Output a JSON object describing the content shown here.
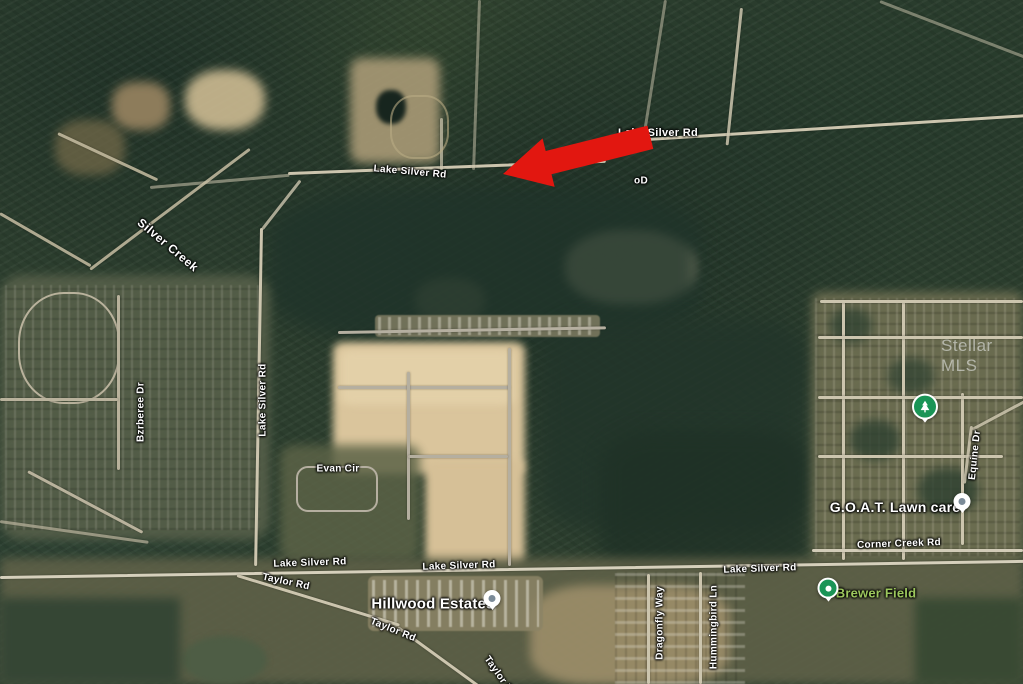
{
  "map": {
    "imagery": "satellite",
    "watermark": "Stellar MLS",
    "colors": {
      "forest_dark": "#1f3126",
      "forest": "#2c3e2e",
      "clearing_sand": "#dac59c",
      "clearing_brown": "#9b8a66",
      "road": "#ccc5ae",
      "road_gray": "#b5afa0",
      "water": "#4e5d45",
      "arrow_red": "#e21710",
      "poi_pin_green": "#1a9456",
      "park_label_green": "#9cc75d",
      "label_white": "#ffffff"
    },
    "road_labels": [
      {
        "text": "Lake Silver Rd",
        "x": 658,
        "y": 133,
        "rot": 0,
        "fs": 11
      },
      {
        "text": "Lake Silver Rd",
        "x": 410,
        "y": 172,
        "rot": 5,
        "fs": 10
      },
      {
        "text": "Silver Creek",
        "x": 168,
        "y": 245,
        "rot": 40,
        "fs": 12,
        "cls": "creek"
      },
      {
        "text": "Bzrberee Dr",
        "x": 141,
        "y": 412,
        "rot": -90,
        "fs": 10
      },
      {
        "text": "Lake Silver Rd",
        "x": 263,
        "y": 400,
        "rot": -90,
        "fs": 10
      },
      {
        "text": "Evan Cir",
        "x": 338,
        "y": 469,
        "rot": 0,
        "fs": 10
      },
      {
        "text": "Lake Silver Rd",
        "x": 310,
        "y": 563,
        "rot": -2,
        "fs": 10
      },
      {
        "text": "Lake Silver Rd",
        "x": 459,
        "y": 566,
        "rot": -2,
        "fs": 10
      },
      {
        "text": "Lake Silver Rd",
        "x": 760,
        "y": 569,
        "rot": -2,
        "fs": 10
      },
      {
        "text": "Taylor Rd",
        "x": 286,
        "y": 582,
        "rot": 12,
        "fs": 10
      },
      {
        "text": "Taylor Rd",
        "x": 393,
        "y": 630,
        "rot": 22,
        "fs": 10
      },
      {
        "text": "Taylor Rd",
        "x": 500,
        "y": 677,
        "rot": 55,
        "fs": 10
      },
      {
        "text": "Dragonfly Way",
        "x": 660,
        "y": 623,
        "rot": -90,
        "fs": 10
      },
      {
        "text": "Hummingbird Ln",
        "x": 714,
        "y": 627,
        "rot": -90,
        "fs": 10
      },
      {
        "text": "Corner Creek Rd",
        "x": 899,
        "y": 544,
        "rot": -2,
        "fs": 10
      },
      {
        "text": "Equine Dr",
        "x": 975,
        "y": 455,
        "rot": -84,
        "fs": 10
      }
    ],
    "partial_label": {
      "text": "oD",
      "x": 641,
      "y": 181,
      "rot": 0,
      "fs": 10
    },
    "poi_labels": [
      {
        "text": "Hillwood Estates",
        "x": 433,
        "y": 604,
        "rot": 0,
        "fs": 15,
        "cls": "poi",
        "color": "#ffffff"
      },
      {
        "text": "G.O.A.T. Lawn care",
        "x": 895,
        "y": 507,
        "rot": 0,
        "fs": 14,
        "cls": "poi",
        "color": "#ffffff"
      },
      {
        "text": "Brewer Field",
        "x": 876,
        "y": 593,
        "rot": 0,
        "fs": 13,
        "cls": "poi",
        "color": "#9cc75d"
      }
    ],
    "pins": [
      {
        "kind": "poi-dot",
        "name": "hillwood-estates-pin",
        "x": 492,
        "y": 602
      },
      {
        "kind": "poi-dot",
        "name": "goat-lawn-care-pin",
        "x": 962,
        "y": 505
      },
      {
        "kind": "park-dot",
        "name": "brewer-field-pin",
        "x": 828,
        "y": 592
      },
      {
        "kind": "park-tree",
        "name": "park-pin",
        "x": 925,
        "y": 411
      }
    ],
    "annotation_arrow": {
      "direction": "left",
      "color": "#e21710",
      "x": 503,
      "y": 146,
      "rot": -14
    }
  }
}
